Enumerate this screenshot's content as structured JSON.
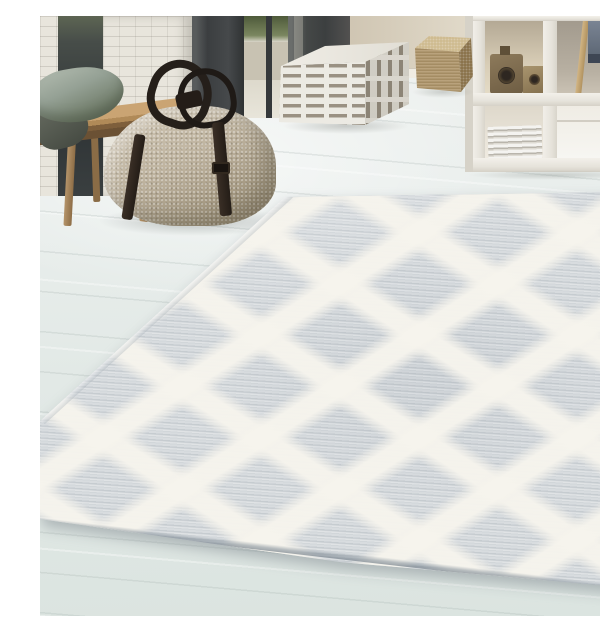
{
  "scene": {
    "type": "interior product photograph",
    "description": "Bright Scandinavian-style room with a large gray and cream diamond-trellis pile rug laid diagonally on a whitewashed wood-plank floor. Behind it: a white-brick wall with dark glass door frames, a wooden bench holding sage-gray cushions, a large woven beige duffel bag with dark leather straps, a white cube pouf with gray broken stripes, a small burlap-tan cube pouf, and a white open cube shelving unit containing wooden toy cameras and a stack of magazines, with a gray chair behind it."
  },
  "objects": {
    "rug": {
      "label": "diamond-trellis high-low pile rug",
      "base_color": "#d8dcdf",
      "pattern_color": "#f4f2eb",
      "edge_color": "#8fa0ab"
    },
    "floor": {
      "label": "whitewashed wood plank floor",
      "color": "#e4eae7"
    },
    "bench": {
      "label": "wooden bench",
      "color": "#b08a58"
    },
    "pillow_main": {
      "label": "sage-gray cushion",
      "color": "#8a968a"
    },
    "pillow_dark": {
      "label": "dark gray cushion",
      "color": "#545a50"
    },
    "bag": {
      "label": "woven beige duffel bag",
      "body_color": "#bfb4a0",
      "strap_color": "#2a231e"
    },
    "pouf_striped": {
      "label": "striped cube pouf",
      "base_color": "#eceae3",
      "stripe_color": "#9a9183"
    },
    "pouf_tan": {
      "label": "burlap tan cube pouf",
      "color": "#b09567"
    },
    "shelf": {
      "label": "white cube shelving unit",
      "color": "#ebe8e1"
    },
    "toy_cameras": {
      "label": "wooden toy cameras",
      "color": "#8d7a5b"
    },
    "magazines": {
      "label": "stacked magazines",
      "color": "#dedbd3"
    },
    "chair": {
      "label": "gray chair behind shelf",
      "color": "#6e7884"
    },
    "door_frames": {
      "label": "dark glass door frames",
      "color": "#3c3f41"
    },
    "brick_wall": {
      "label": "white painted brick wall",
      "color": "#e8e5dc"
    },
    "fireplace": {
      "label": "dark fireplace block",
      "color": "#454847"
    },
    "wall": {
      "label": "warm greige rear wall",
      "color": "#e0d8c8"
    }
  },
  "palette": {
    "floor": "#e4eae7",
    "rug_base": "#d8dcdf",
    "rug_lattice": "#f4f2eb",
    "wood": "#b08a58",
    "dark_frame": "#3c3f41"
  }
}
